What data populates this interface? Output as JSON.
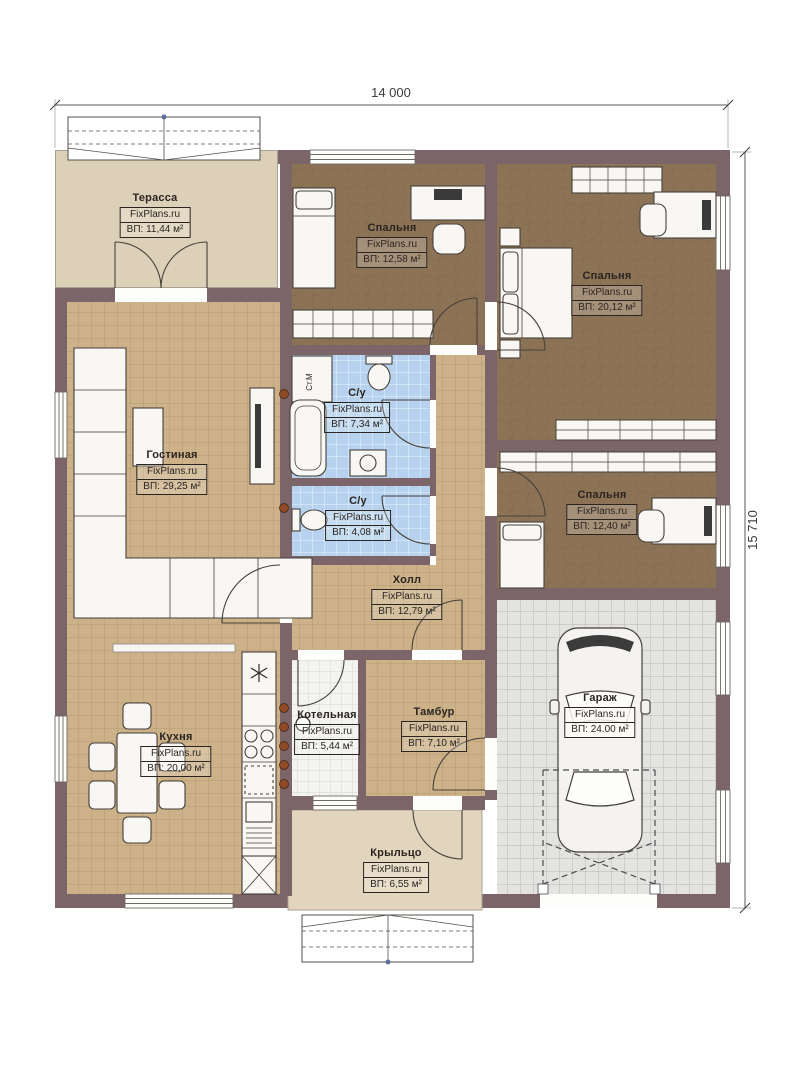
{
  "plan": {
    "brand": "FixPlans.ru",
    "dimensions": {
      "width": "14 000",
      "height": "15 710"
    },
    "labels": {
      "washing_machine": "Ст.М"
    },
    "colors": {
      "wall": "#7b6569",
      "floor_tan": "#ccb189",
      "floor_bedroom": "#8d7356",
      "floor_bath": "#b6d2ef",
      "floor_garage": "#e3e3e1",
      "floor_boiler": "#f3f3f0",
      "terrace": "#ddd0b8",
      "porch": "#e2d5bd"
    },
    "rooms": [
      {
        "id": "terrace",
        "name": "Терасса",
        "area": "ВП: 11,44 м²"
      },
      {
        "id": "bedroom-top",
        "name": "Спальня",
        "area": "ВП: 12,58 м²"
      },
      {
        "id": "bedroom-right-top",
        "name": "Спальня",
        "area": "ВП: 20,12 м²"
      },
      {
        "id": "bathroom-large",
        "name": "С/у",
        "area": "ВП: 7,34 м²"
      },
      {
        "id": "bathroom-small",
        "name": "С/у",
        "area": "ВП: 4,08 м²"
      },
      {
        "id": "living-room",
        "name": "Гостиная",
        "area": "ВП: 29,25 м²"
      },
      {
        "id": "bedroom-right-middle",
        "name": "Спальня",
        "area": "ВП: 12,40 м²"
      },
      {
        "id": "hall",
        "name": "Холл",
        "area": "ВП: 12,79 м²"
      },
      {
        "id": "kitchen",
        "name": "Кухня",
        "area": "ВП: 20,00 м²"
      },
      {
        "id": "boiler-room",
        "name": "Котельная",
        "area": "ВП: 5,44 м²"
      },
      {
        "id": "vestibule",
        "name": "Тамбур",
        "area": "ВП: 7,10 м²"
      },
      {
        "id": "garage",
        "name": "Гараж",
        "area": "ВП: 24.00 м²"
      },
      {
        "id": "porch",
        "name": "Крыльцо",
        "area": "ВП: 6,55 м²"
      }
    ]
  }
}
